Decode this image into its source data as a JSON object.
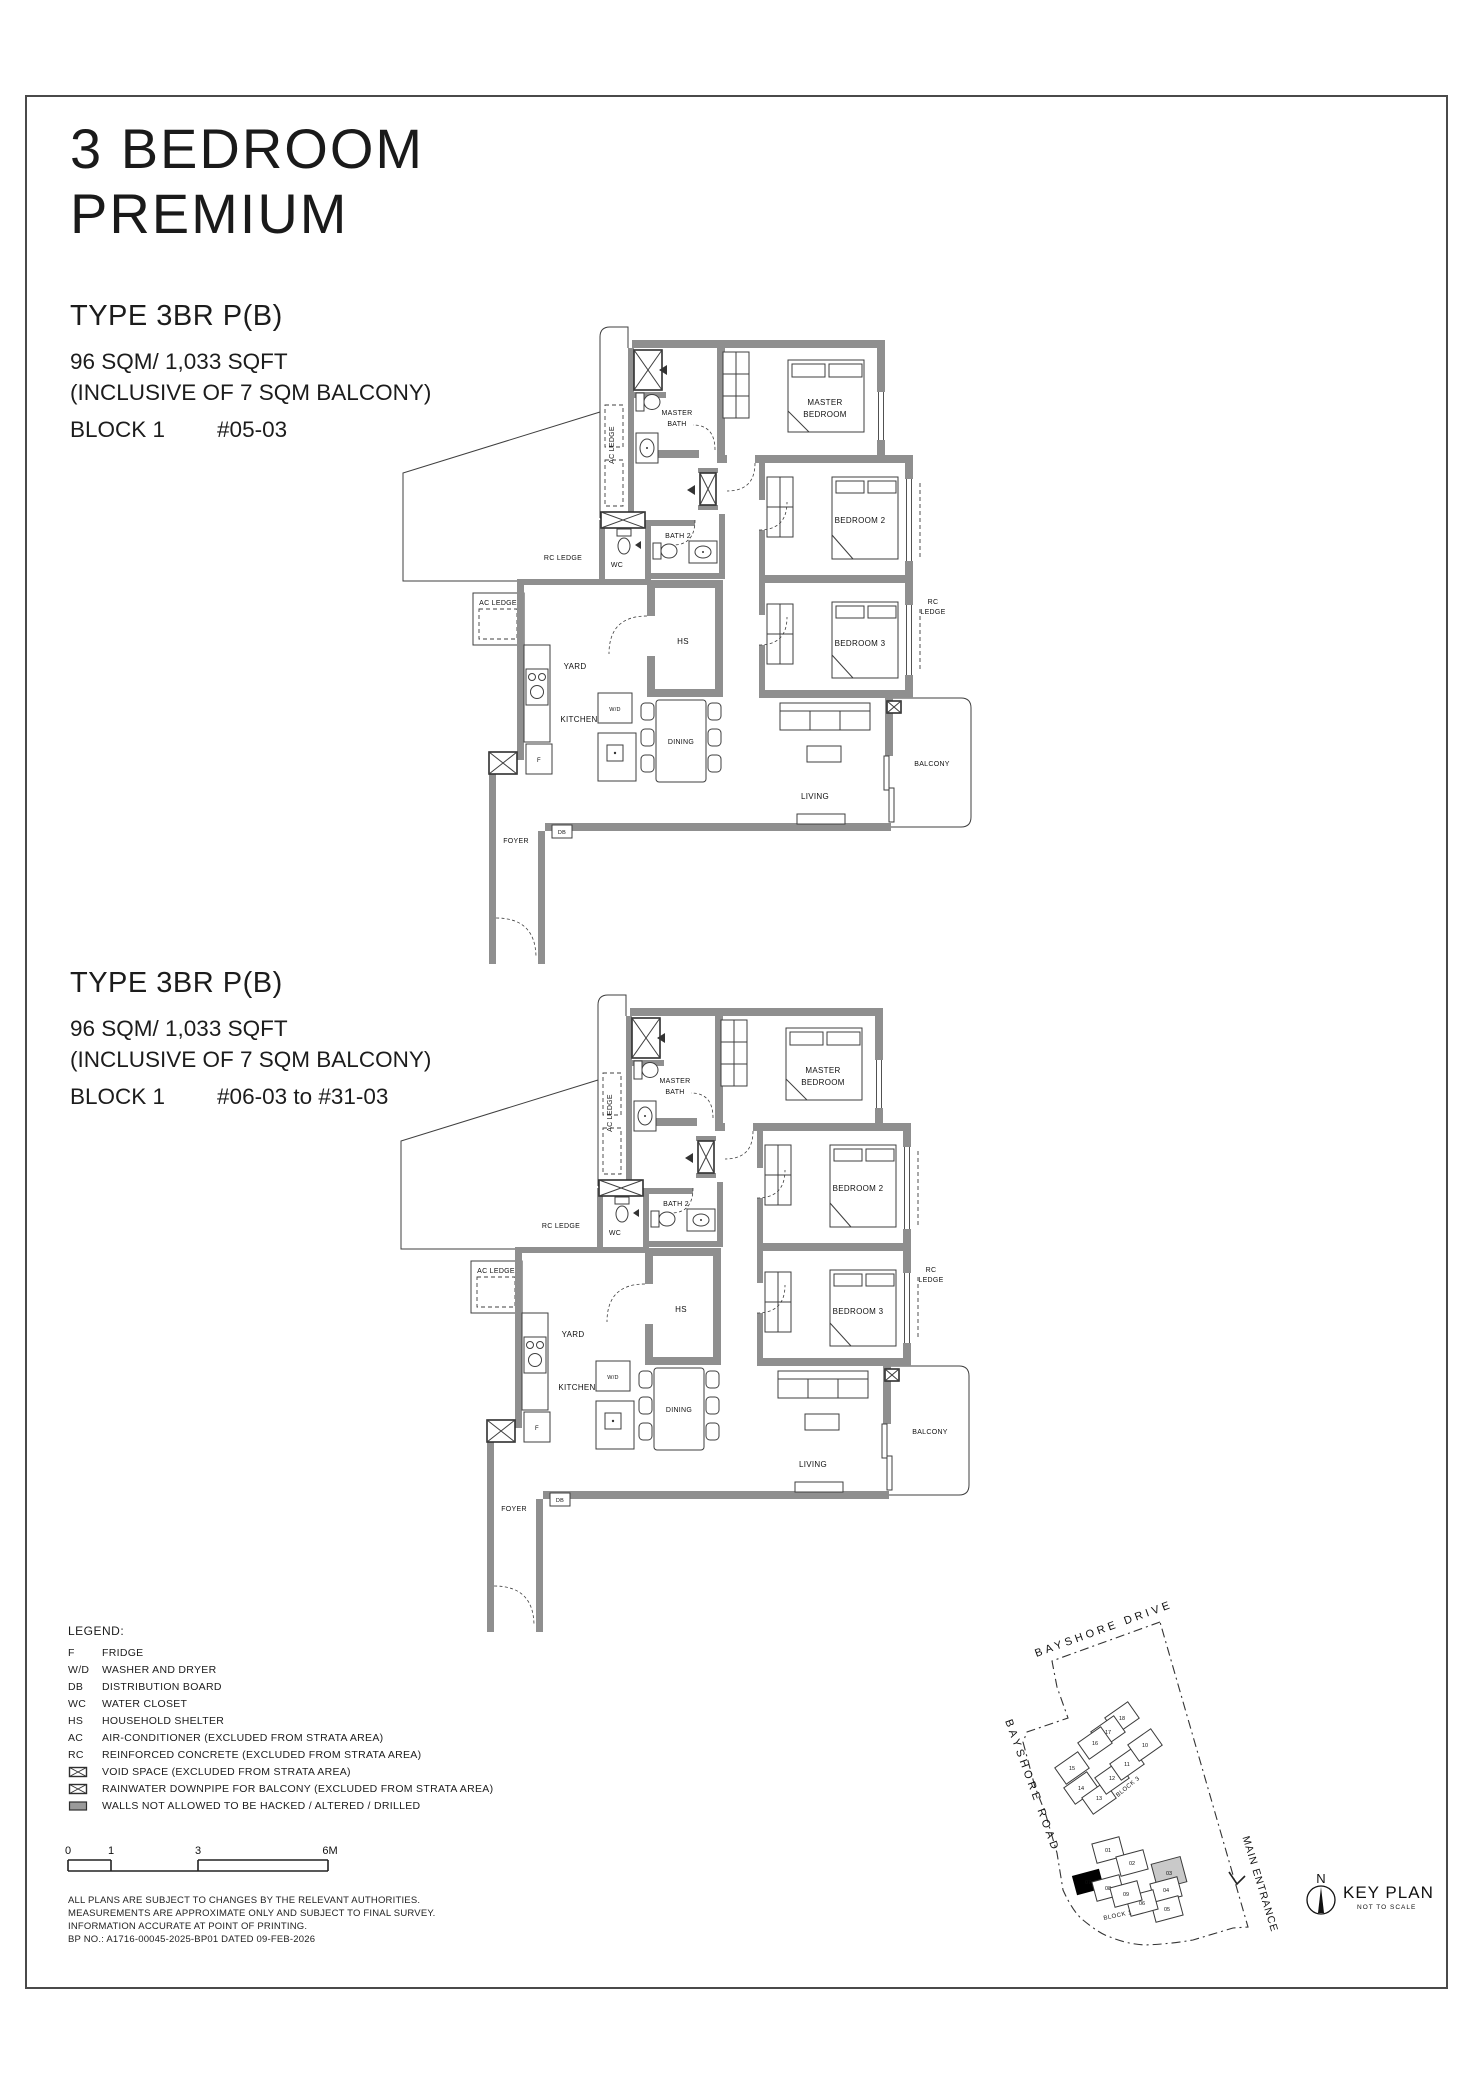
{
  "page": {
    "title_line1": "3 BEDROOM",
    "title_line2": "PREMIUM"
  },
  "units": [
    {
      "type": "TYPE 3BR P(B)",
      "area": "96 SQM/ 1,033 SQFT",
      "area_note": "(INCLUSIVE OF 7 SQM BALCONY)",
      "block": "BLOCK 1",
      "stack": "#05-03"
    },
    {
      "type": "TYPE 3BR P(B)",
      "area": "96 SQM/ 1,033 SQFT",
      "area_note": "(INCLUSIVE OF 7 SQM BALCONY)",
      "block": "BLOCK 1",
      "stack": "#06-03 to #31-03"
    }
  ],
  "floorplan": {
    "master_bedroom_1": "MASTER",
    "master_bedroom_2": "BEDROOM",
    "master_bath_1": "MASTER",
    "master_bath_2": "BATH",
    "bedroom2": "BEDROOM 2",
    "bedroom3": "BEDROOM 3",
    "bath2": "BATH 2",
    "wc": "WC",
    "hs": "HS",
    "yard": "YARD",
    "kitchen": "KITCHEN",
    "dining": "DINING",
    "living": "LIVING",
    "balcony": "BALCONY",
    "foyer": "FOYER",
    "ac_ledge": "AC LEDGE",
    "ac_ledge2": "AC LEDGE",
    "rc_ledge": "RC LEDGE",
    "rc": "RC",
    "ledge": "LEDGE",
    "fridge": "F",
    "washer_dryer": "W/D",
    "db": "DB"
  },
  "legend": {
    "title": "LEGEND:",
    "items": [
      {
        "key": "F",
        "label": "FRIDGE"
      },
      {
        "key": "W/D",
        "label": "WASHER AND DRYER"
      },
      {
        "key": "DB",
        "label": "DISTRIBUTION BOARD"
      },
      {
        "key": "WC",
        "label": "WATER CLOSET"
      },
      {
        "key": "HS",
        "label": "HOUSEHOLD SHELTER"
      },
      {
        "key": "AC",
        "label": "AIR-CONDITIONER (EXCLUDED FROM STRATA AREA)"
      },
      {
        "key": "RC",
        "label": "REINFORCED CONCRETE (EXCLUDED FROM STRATA AREA)"
      },
      {
        "icon": "void-box-icon",
        "label": "VOID SPACE (EXCLUDED FROM STRATA AREA)"
      },
      {
        "icon": "rainwater-downpipe-box-icon",
        "label": "RAINWATER DOWNPIPE FOR BALCONY (EXCLUDED FROM STRATA AREA)"
      },
      {
        "icon": "hacked-wall-swatch-icon",
        "label": "WALLS NOT ALLOWED TO BE HACKED / ALTERED / DRILLED"
      }
    ]
  },
  "scalebar": {
    "labels": [
      "0",
      "1",
      "3",
      "6M"
    ]
  },
  "notes": {
    "line1": "ALL PLANS ARE SUBJECT TO CHANGES BY THE RELEVANT AUTHORITIES.",
    "line2": "MEASUREMENTS ARE APPROXIMATE ONLY AND SUBJECT TO FINAL SURVEY.",
    "line3": "INFORMATION ACCURATE AT POINT OF PRINTING.",
    "line4": "BP NO.: A1716-00045-2025-BP01 DATED 09-FEB-2026"
  },
  "keyplan": {
    "road_top": "BAYSHORE DRIVE",
    "road_left": "BAYSHORE ROAD",
    "entrance": "MAIN ENTRANCE",
    "blocks": [
      {
        "name": "BLOCK 3",
        "units": [
          "18",
          "17",
          "16",
          "15",
          "14",
          "13",
          "12",
          "11",
          "10"
        ]
      },
      {
        "name": "BLOCK 1",
        "units": [
          "01",
          "02",
          "03",
          "04",
          "05",
          "06",
          "07",
          "08",
          "09"
        ]
      }
    ],
    "highlighted_unit": "03",
    "compass": "N",
    "title": "KEY PLAN",
    "subtitle": "NOT TO SCALE"
  }
}
